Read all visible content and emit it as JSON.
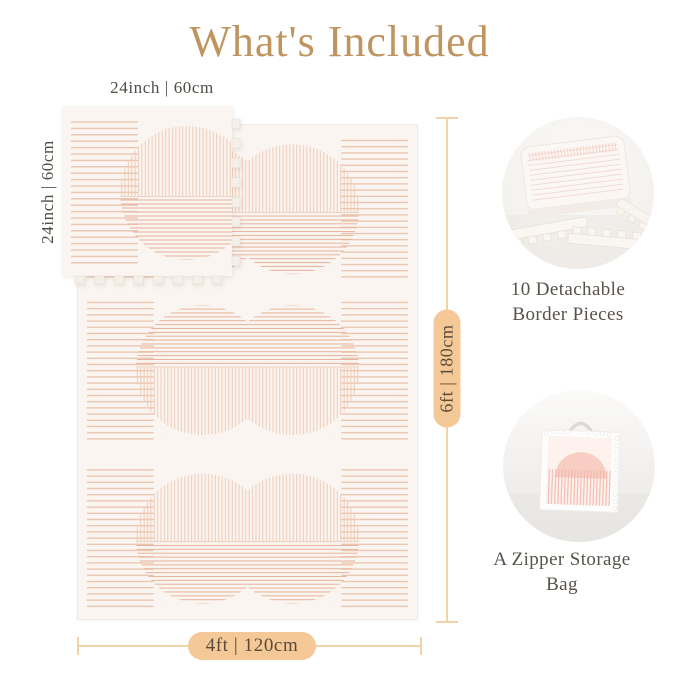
{
  "title": {
    "text": "What's Included"
  },
  "tile": {
    "top_label": "24inch | 60cm",
    "side_label": "24inch | 60cm"
  },
  "mat_dimensions": {
    "height_label": "6ft | 180cm",
    "width_label": "4ft | 120cm"
  },
  "features": [
    {
      "id": "border-pieces",
      "label_lines": [
        "10 Detachable",
        "Border Pieces"
      ]
    },
    {
      "id": "storage-bag",
      "label_lines": [
        "A Zipper Storage Bag"
      ]
    }
  ],
  "colors": {
    "title": "#c0945f",
    "label_text": "#514d47",
    "feature_text": "#57534b",
    "pill_background": "#f4c897",
    "pill_text": "#5a4b38",
    "dimension_line": "#f1d3a8",
    "stripe_peach": "#e9bfaa",
    "mat_background": "#faf5f0"
  }
}
